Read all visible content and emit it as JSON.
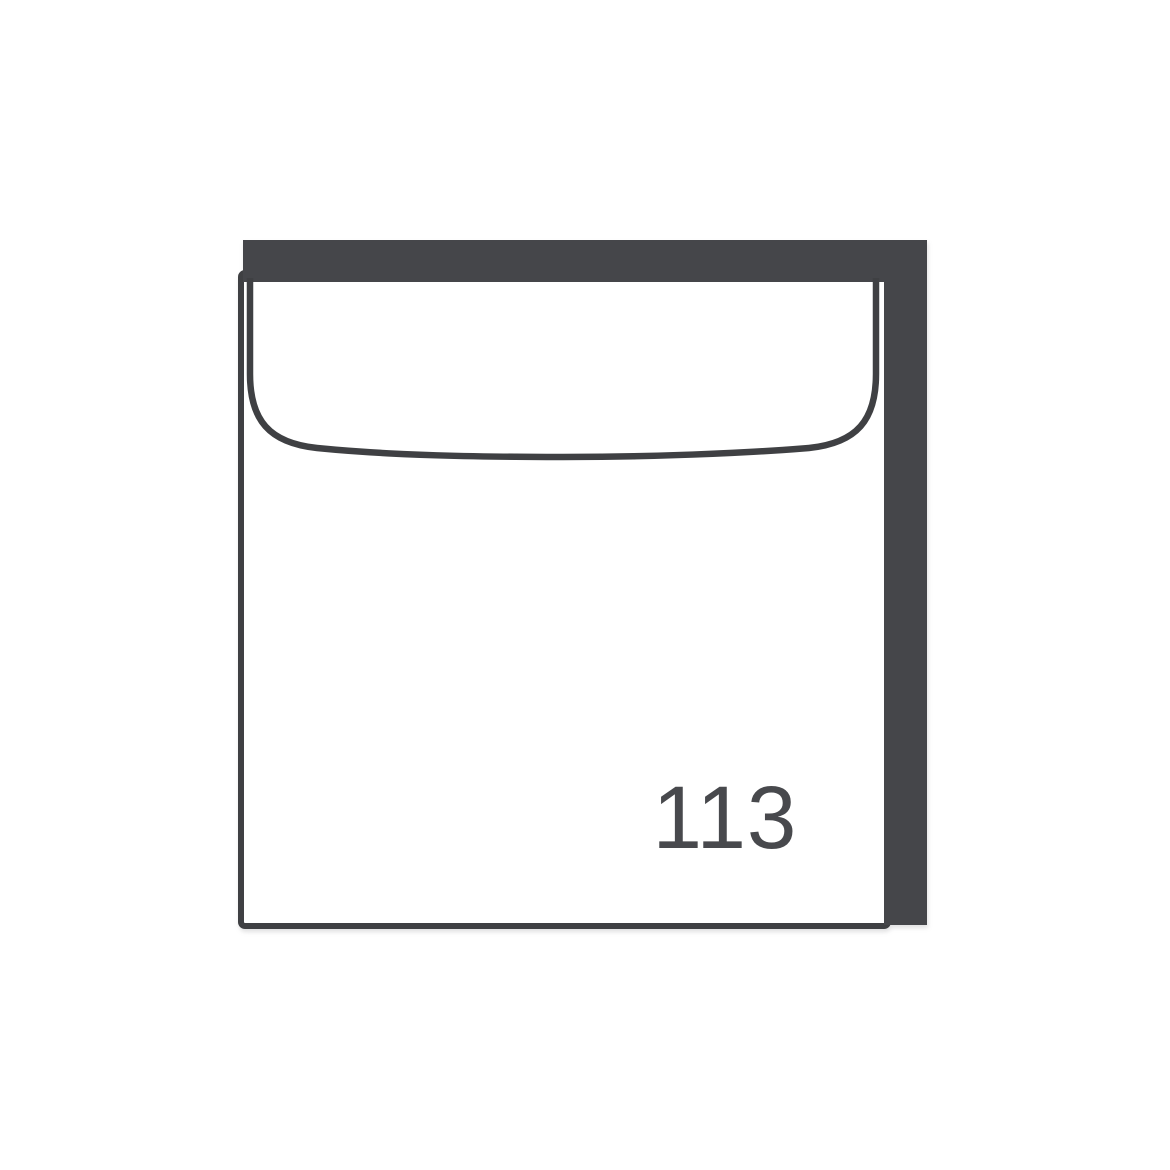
{
  "module": {
    "width_label": "113"
  },
  "colors": {
    "background": "#ffffff",
    "frame_fill": "#45464a",
    "outline_stroke": "#3f4043",
    "label_text": "#48494d"
  }
}
